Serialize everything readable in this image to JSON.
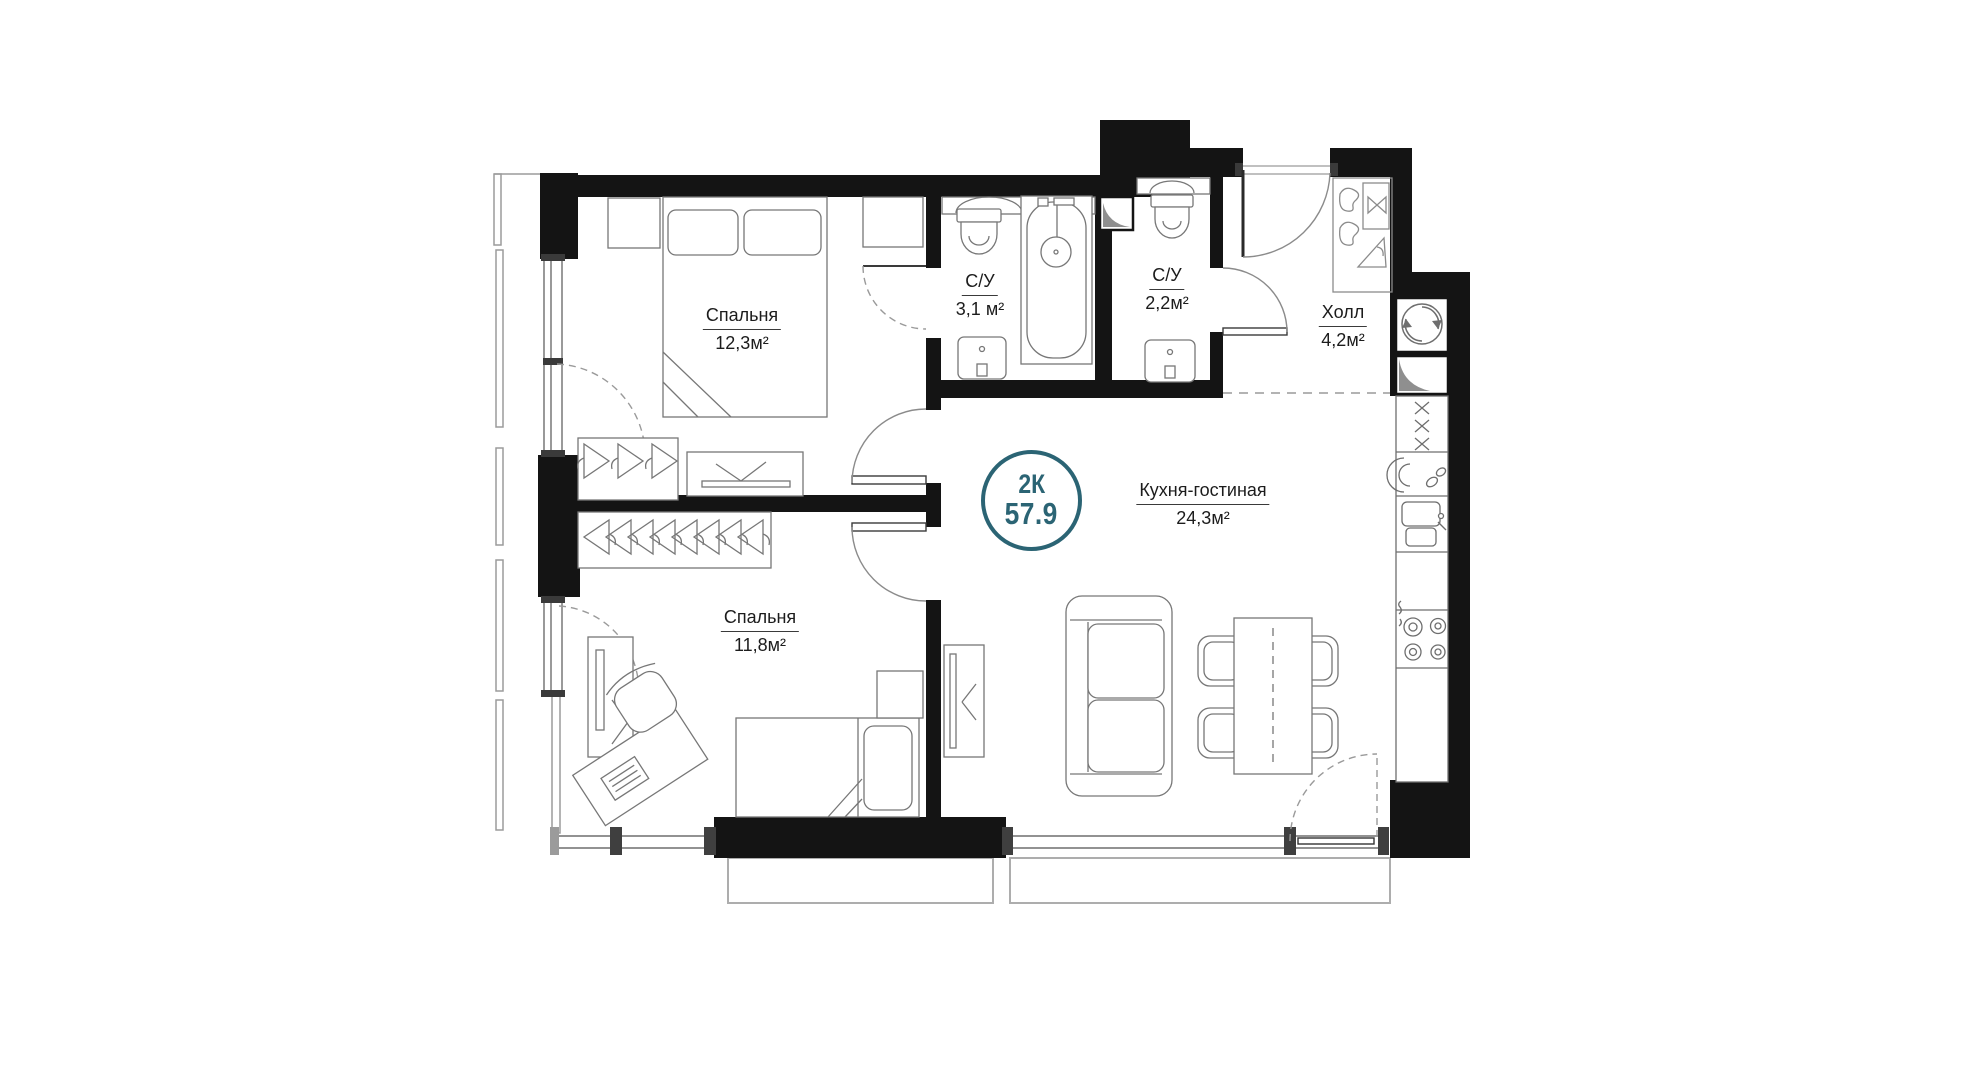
{
  "floorplan": {
    "badge": {
      "type": "2К",
      "total_area": "57.9"
    },
    "rooms": [
      {
        "name": "Спальня",
        "area": "12,3м²"
      },
      {
        "name": "С/У",
        "area": "3,1 м²"
      },
      {
        "name": "С/У",
        "area": "2,2м²"
      },
      {
        "name": "Холл",
        "area": "4,2м²"
      },
      {
        "name": "Кухня-гостиная",
        "area": "24,3м²"
      },
      {
        "name": "Спальня",
        "area": "11,8м²"
      }
    ],
    "colors": {
      "accent": "#2b6474",
      "walls": "#141414",
      "lines": "#6e6e6e"
    }
  }
}
